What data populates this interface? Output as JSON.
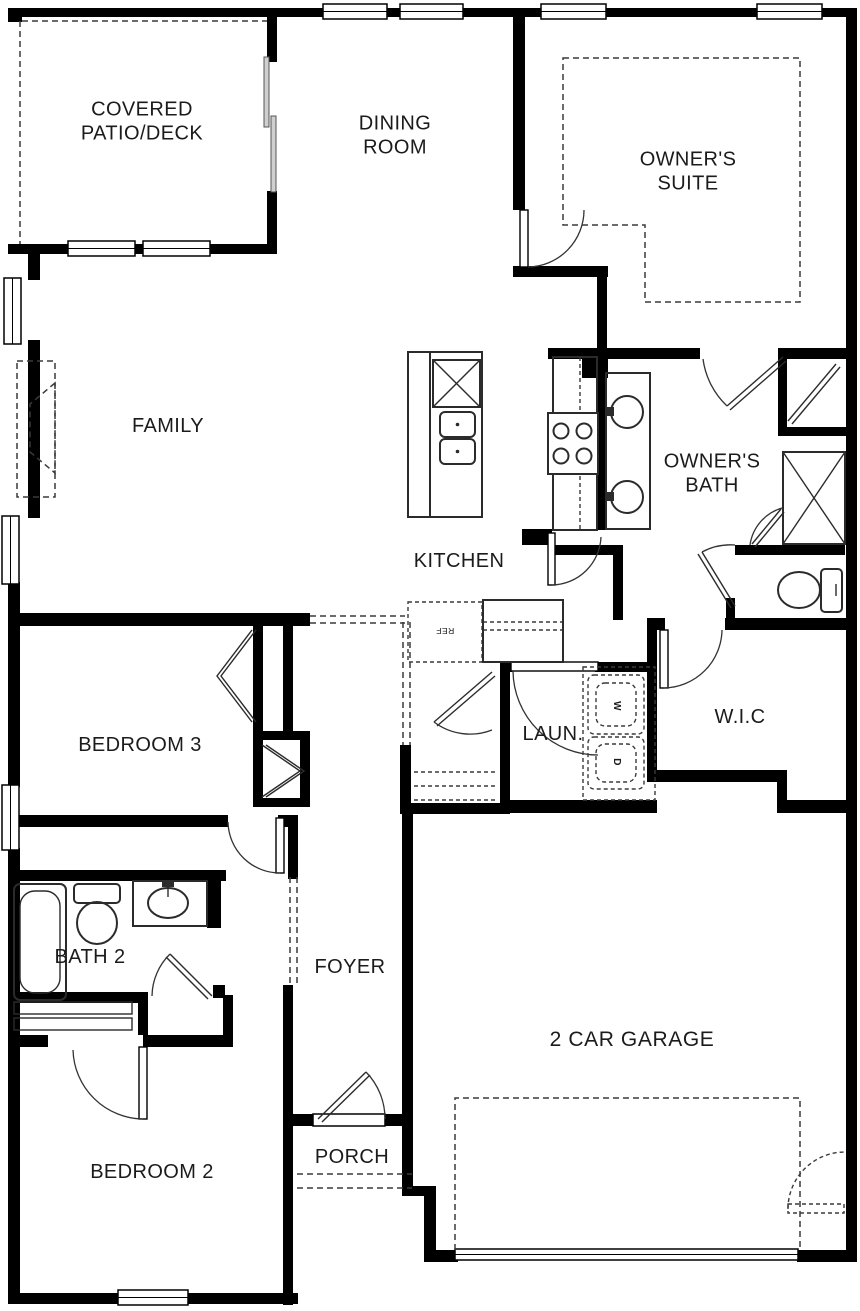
{
  "plan": {
    "kind": "single-story-floor-plan"
  },
  "colors": {
    "wall": "#000000",
    "line": "#2b2b2b",
    "dash": "#3a3a3a",
    "background": "#ffffff"
  },
  "rooms": [
    {
      "id": "covered-patio-deck",
      "label": "COVERED\nPATIO/DECK"
    },
    {
      "id": "dining-room",
      "label": "DINING\nROOM"
    },
    {
      "id": "owners-suite",
      "label": "OWNER'S\nSUITE"
    },
    {
      "id": "family",
      "label": "FAMILY"
    },
    {
      "id": "kitchen",
      "label": "KITCHEN"
    },
    {
      "id": "owners-bath",
      "label": "OWNER'S\nBATH"
    },
    {
      "id": "bedroom-3",
      "label": "BEDROOM 3"
    },
    {
      "id": "laundry",
      "label": "LAUN."
    },
    {
      "id": "walk-in-closet",
      "label": "W.I.C"
    },
    {
      "id": "bath-2",
      "label": "BATH 2"
    },
    {
      "id": "foyer",
      "label": "FOYER"
    },
    {
      "id": "garage",
      "label": "2 CAR GARAGE"
    },
    {
      "id": "bedroom-2",
      "label": "BEDROOM 2"
    },
    {
      "id": "porch",
      "label": "PORCH"
    }
  ],
  "appliances": {
    "refrigerator": "REF",
    "washer": "W",
    "dryer": "D"
  },
  "fixtures": [
    "kitchen-island",
    "island-double-sink",
    "range-cooktop",
    "refrigerator",
    "washer",
    "dryer",
    "owners-bath-double-vanity",
    "shower",
    "toilet",
    "water-closet-toilet",
    "bathtub",
    "bath2-vanity-sink",
    "linen-shelves",
    "closet-bifold-doors",
    "sliding-glass-door",
    "front-door",
    "garage-door",
    "garage-service-door",
    "porch-steps",
    "tray-ceiling-outline",
    "optional-fireplace",
    "garage-pad-outline"
  ]
}
